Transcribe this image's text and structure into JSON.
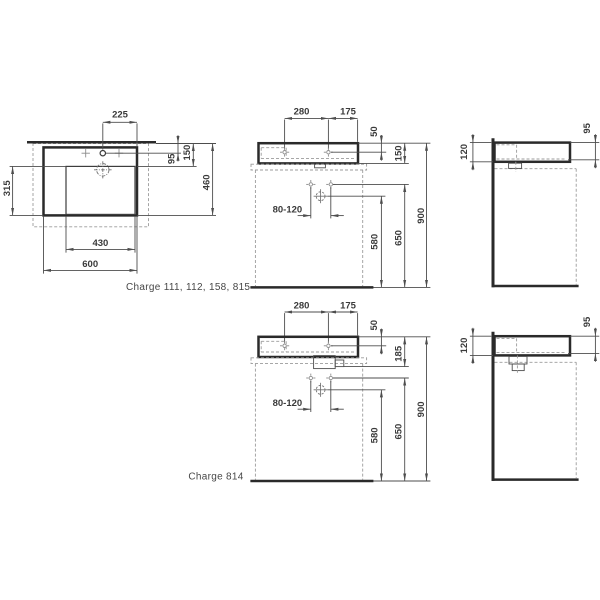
{
  "palette": {
    "background": "#ffffff",
    "outline": "#2a2a2a",
    "thin_line": "#4d4d4d",
    "dashed_line": "#9b9b9b",
    "text": "#3a3a3a"
  },
  "captions": {
    "group_a": "Charge 111, 112, 158, 815",
    "group_b": "Charge 814"
  },
  "plan": {
    "dims": {
      "taphole_to_side": "225",
      "wall_to_taphole": "95",
      "wall_to_bowl": "150",
      "overall_depth": "460",
      "bowl_depth": "315",
      "bowl_width": "430",
      "overall_width": "600"
    }
  },
  "front_shared": {
    "dims": {
      "taphole_spacing": "280",
      "taphole_to_side": "175",
      "rim_to_taphole": "50",
      "fixing_bolt_range": "80-120",
      "drain_height": "580",
      "fixing_height": "650",
      "rim_height": "900"
    }
  },
  "front_a": {
    "dims": {
      "basin_height": "150"
    }
  },
  "front_b": {
    "dims": {
      "basin_height": "185"
    }
  },
  "side_shared": {
    "dims": {
      "apron_height": "120",
      "rim_to_shelf": "95"
    }
  }
}
